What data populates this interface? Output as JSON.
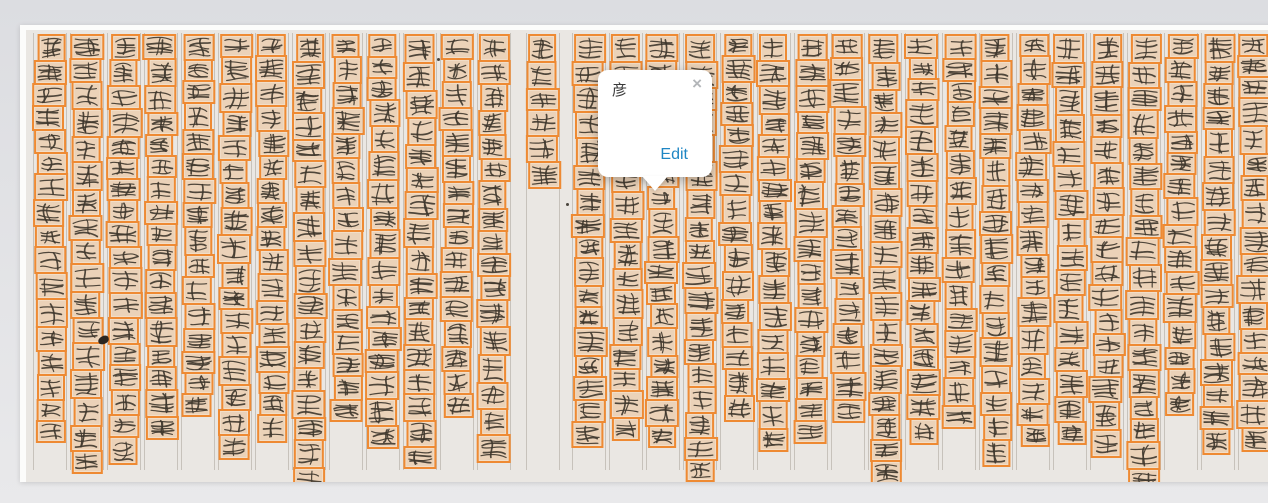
{
  "theme": {
    "app_background": "#dcdde1",
    "app_background_bottom": "#e9e9eb",
    "page_background": "#eae7e3",
    "page_edge": "#fcfcfb",
    "rule_color": "rgba(164,158,148,0.5)",
    "box_border": "#ee8a33",
    "box_fill": "rgba(241,152,61,0.26)",
    "ink": "#3e362c",
    "popup_bg": "#ffffff",
    "edit_color": "#1e86c4",
    "close_color": "#b3b6b9"
  },
  "popup": {
    "character": "彦",
    "edit_label": "Edit",
    "close_label": "×"
  },
  "manuscript": {
    "groups": [
      {
        "name": "left",
        "columns": [
          17,
          17,
          18,
          17,
          16,
          17,
          17,
          18,
          16,
          17,
          17,
          16,
          17
        ]
      },
      {
        "name": "center-short",
        "columns": [
          6
        ]
      },
      {
        "name": "right",
        "columns": [
          17,
          16,
          17,
          18,
          16,
          17,
          17,
          16,
          18,
          17,
          16,
          17,
          17,
          16,
          17,
          18,
          16,
          17,
          17,
          16
        ]
      }
    ]
  }
}
